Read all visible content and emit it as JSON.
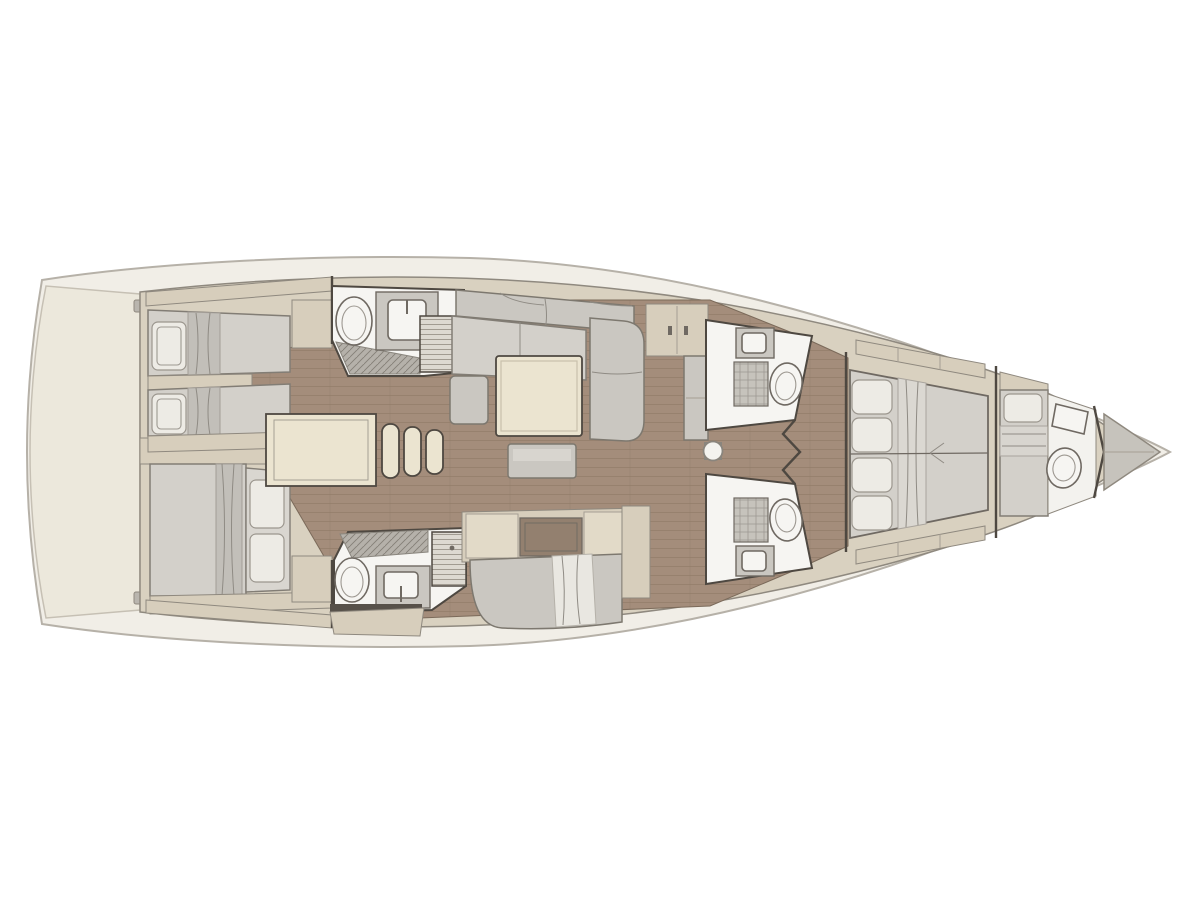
{
  "diagram": {
    "kind": "sailing-yacht-interior-floor-plan",
    "orientation": "bow-right-stern-left",
    "visible_text": []
  },
  "colors": {
    "background": "#ffffff",
    "hull_band": "#f1eee7",
    "hull_stroke": "#b6b1a8",
    "deck_line": "#8f897f",
    "platform": "#ece8dc",
    "interior_base": "#d9d1c0",
    "floor_teak": "#a48d7b",
    "plank_line": "#8c7663",
    "wall": "#4e4841",
    "room_white": "#f6f5f2",
    "furniture_gray": "#cac7c1",
    "mattress": "#d3d0ca",
    "pillow": "#edebe5",
    "blanket": "#c2bfb9",
    "beige": "#d7cebc",
    "cream": "#ebe4d0",
    "counter_dark": "#93806f",
    "shower_base": "#b5b1aa",
    "hatch_line": "#857f77",
    "louver_base": "#ddd9d1",
    "louver_line": "#a19b91",
    "fixture_stroke": "#6f6962"
  },
  "icons": {
    "toilet": "oval-bowl-glyph",
    "sink": "basin-in-vanity-glyph",
    "shower": "diagonal-hatched-floor",
    "locker_grate": "grid-hatched-panel",
    "louver_locker": "horizontal-slat-panel",
    "bed": "mattress-with-pillow-and-blanket",
    "stairs": "stepped-rounded-bars",
    "mast_post": "circle-on-square",
    "anchor_locker": "bow-triangle"
  },
  "rooms": [
    {
      "name": "swim-platform"
    },
    {
      "name": "aft-cabin-port",
      "beds": 2
    },
    {
      "name": "aft-cabin-starboard",
      "beds": 1
    },
    {
      "name": "aft-head-port"
    },
    {
      "name": "aft-head-starboard"
    },
    {
      "name": "companionway"
    },
    {
      "name": "salon"
    },
    {
      "name": "galley"
    },
    {
      "name": "forward-head-port"
    },
    {
      "name": "forward-head-starboard"
    },
    {
      "name": "owner-cabin"
    },
    {
      "name": "bow-cabin"
    },
    {
      "name": "anchor-locker"
    }
  ]
}
